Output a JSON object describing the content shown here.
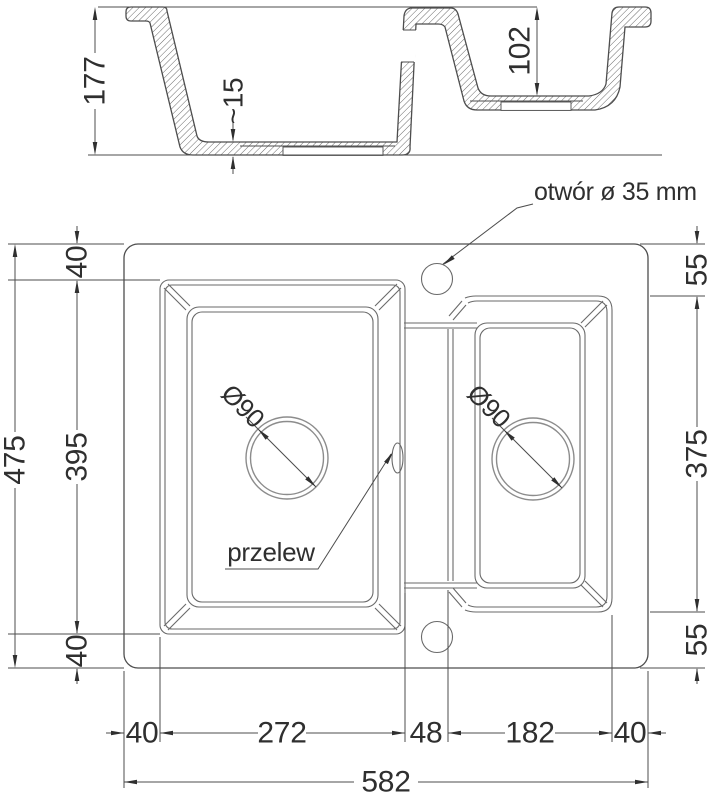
{
  "colors": {
    "background": "#ffffff",
    "line": "#4d4d4d",
    "contour": "#6a6a6a",
    "text": "#2f2f2f",
    "drain_ring": "#8c8c8c"
  },
  "section_view": {
    "main_bowl_depth": "177",
    "bottom_thickness": "~15",
    "small_bowl_depth": "102"
  },
  "plan_view": {
    "tap_hole_label": "otwór ø 35 mm",
    "overflow_label": "przelew",
    "main_drain_diameter": "Ø90",
    "small_drain_diameter": "Ø90",
    "left_dims": {
      "total": "475",
      "top_margin": "40",
      "main_bowl": "395",
      "bottom_margin": "40"
    },
    "right_dims": {
      "top_margin": "55",
      "small_bowl": "375",
      "bottom_margin": "55"
    },
    "bottom_dims": {
      "left_margin": "40",
      "main_bowl": "272",
      "divider": "48",
      "small_bowl": "182",
      "right_margin": "40",
      "total": "582"
    }
  }
}
